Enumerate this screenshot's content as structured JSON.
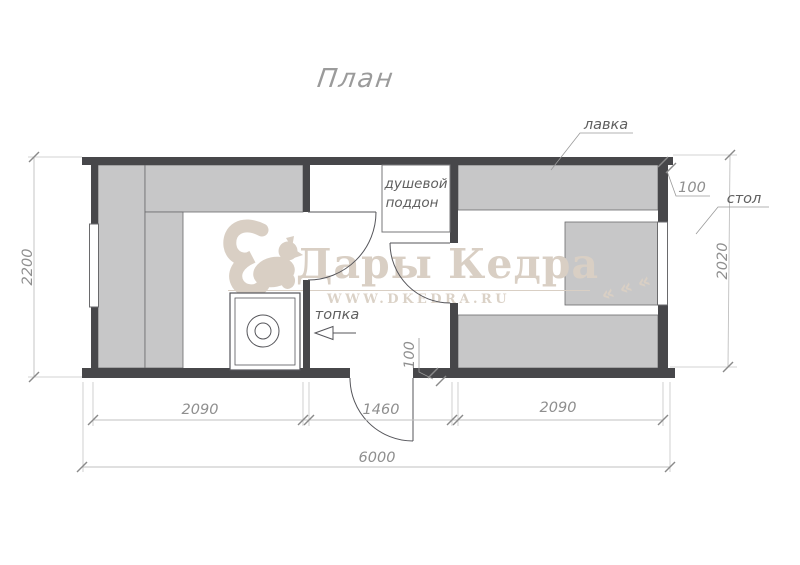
{
  "title": "План",
  "watermark": {
    "brand": "Дары Кедра",
    "website": "WWW.DKEDRA.RU"
  },
  "icons": {
    "branch_chevron": "«",
    "squirrel": "squirrel-logo"
  },
  "labels": {
    "bench": "лавка",
    "table": "стол",
    "shower_tray_line1": "душевой",
    "shower_tray_line2": "поддон",
    "furnace": "топка"
  },
  "dimensions": {
    "overall_width": "6000",
    "left_room_width": "2090",
    "middle_room_width": "1460",
    "right_room_width": "2090",
    "overall_depth": "2200",
    "right_room_depth": "2020",
    "top_wall_thickness": "100",
    "bottom_wall_thickness": "100"
  },
  "colors": {
    "wall": "#47474a",
    "bench_fill": "#c7c7c8",
    "line": "#55555a",
    "dimension": "#8f8f8f",
    "label": "#5f5f5f",
    "watermark": "#d9cfc4",
    "background": "#ffffff"
  }
}
